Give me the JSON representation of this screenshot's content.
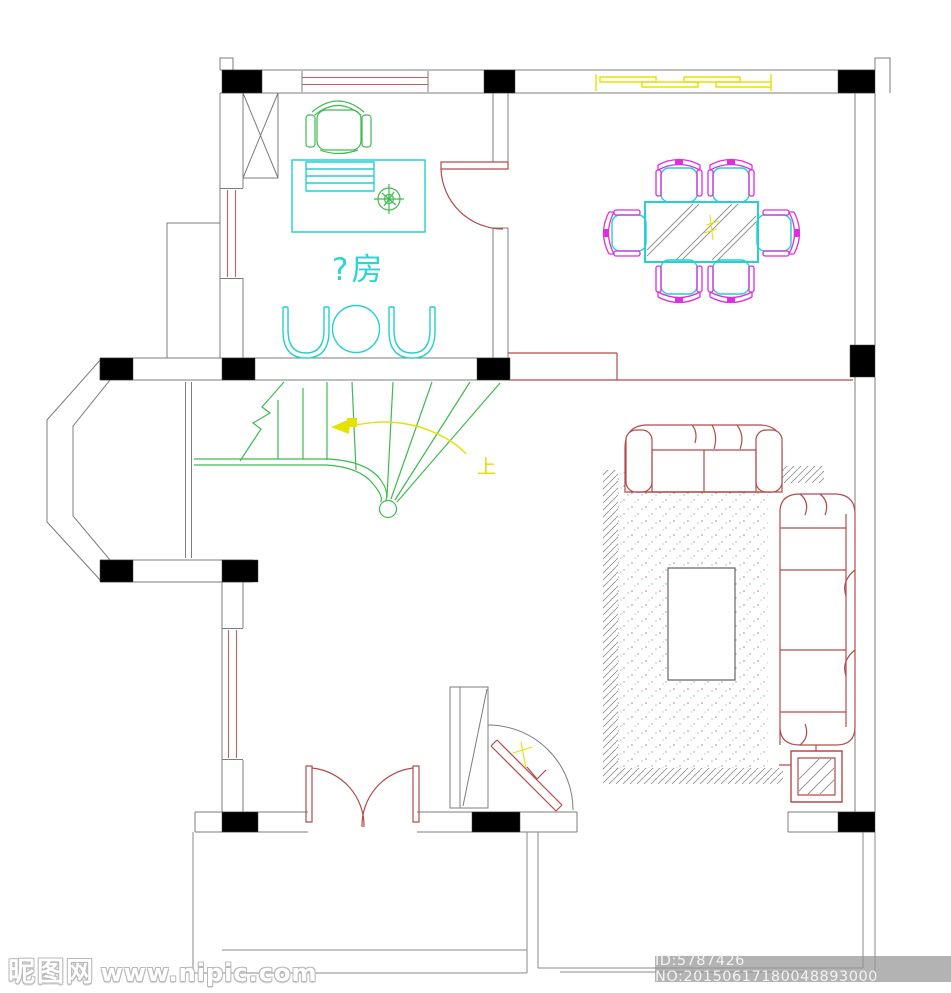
{
  "document": {
    "type": "floor-plan-drawing",
    "background": "#ffffff"
  },
  "plan": {
    "labels": {
      "study_room": "?房",
      "stairs_up": "上"
    },
    "colors": {
      "walls": "#7c7c7c",
      "columns": "#000000",
      "red_furniture_doors": "#b34b4b",
      "cyan_furniture": "#25d0d0",
      "green_stairs": "#3fba4f",
      "magenta_chairs": "#de2ede",
      "yellow_annotations": "#e6e200",
      "hatch": "#8a8a8a"
    },
    "rooms": {
      "study": "study room with desk, office chair and tea table",
      "dining": "dining table with six chairs",
      "living": "sofa set with rug and coffee table",
      "stairs": "curved stair with up arrow",
      "entrance": "double entry door and pivot door"
    }
  },
  "watermark": {
    "site_name": "昵图网",
    "site_url": "www.nipic.com",
    "id_text": "ID:5787426 NO:20150617180048893000"
  }
}
